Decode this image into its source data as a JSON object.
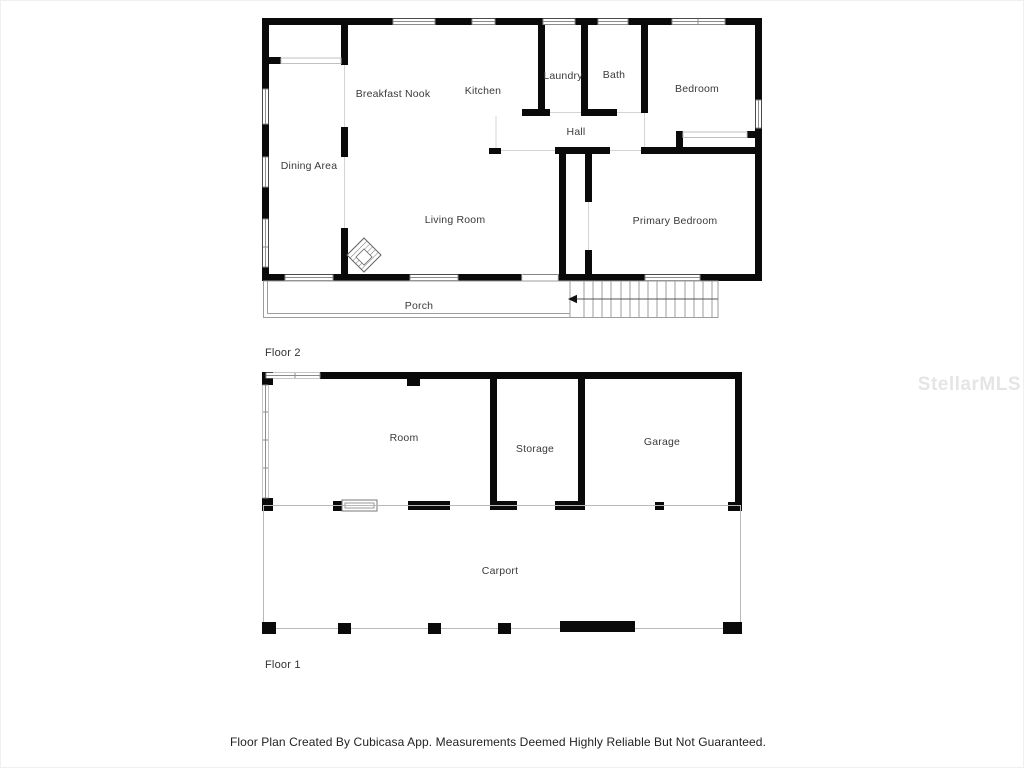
{
  "watermark": {
    "text": "StellarMLS"
  },
  "footer": {
    "disclaimer": "Floor Plan Created By Cubicasa App. Measurements Deemed Highly Reliable But Not Guaranteed."
  },
  "floor2": {
    "label": "Floor 2",
    "rooms": {
      "dining_area": "Dining Area",
      "breakfast_nook": "Breakfast Nook",
      "kitchen": "Kitchen",
      "laundry": "Laundry",
      "bath": "Bath",
      "bedroom": "Bedroom",
      "hall": "Hall",
      "living_room": "Living Room",
      "primary_bedroom": "Primary Bedroom",
      "porch": "Porch"
    }
  },
  "floor1": {
    "label": "Floor 1",
    "rooms": {
      "room": "Room",
      "storage": "Storage",
      "garage": "Garage",
      "carport": "Carport"
    }
  },
  "colors": {
    "wall": "#0a0a0a",
    "opening": "#d4d4d4",
    "outline": "#9e9e9e",
    "label": "#3a3a3a",
    "watermark": "#e5e5e5"
  }
}
